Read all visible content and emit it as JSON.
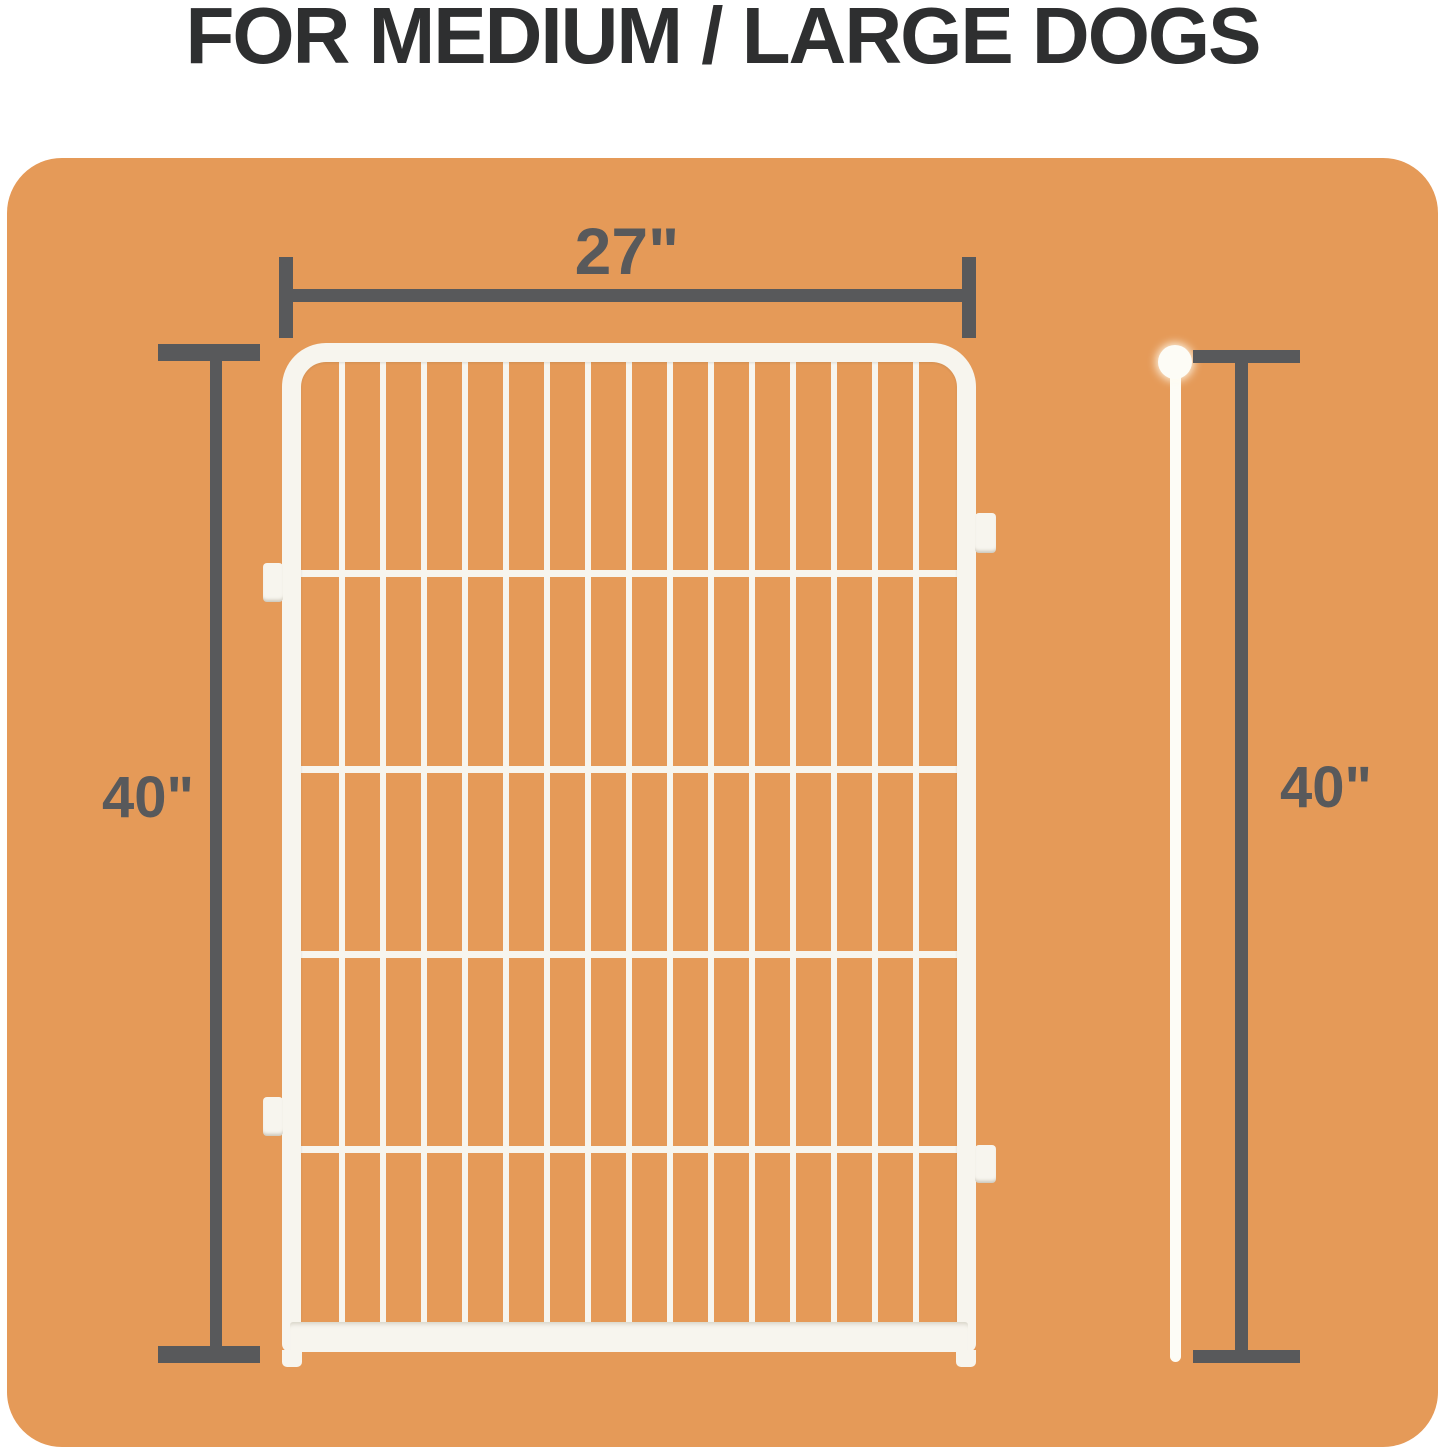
{
  "page": {
    "title": "FOR MEDIUM / LARGE DOGS"
  },
  "diagram": {
    "width_dimension": {
      "label": "27\""
    },
    "left_height_dimension": {
      "label": "40\""
    },
    "right_height_dimension": {
      "label": "40\""
    },
    "fence": {
      "vertical_wire_count": 15,
      "horizontal_wire_offsets_px": [
        208,
        404,
        589,
        784
      ],
      "left_tab_count": 2,
      "right_tab_count": 2
    },
    "colors": {
      "page_background": "#ffffff",
      "panel_background": "#e59a58",
      "dimension_gray": "#58595b",
      "fence_white": "#f7f5ee",
      "pole_white": "#fdfcf6",
      "title_color": "#2e2f30"
    }
  }
}
